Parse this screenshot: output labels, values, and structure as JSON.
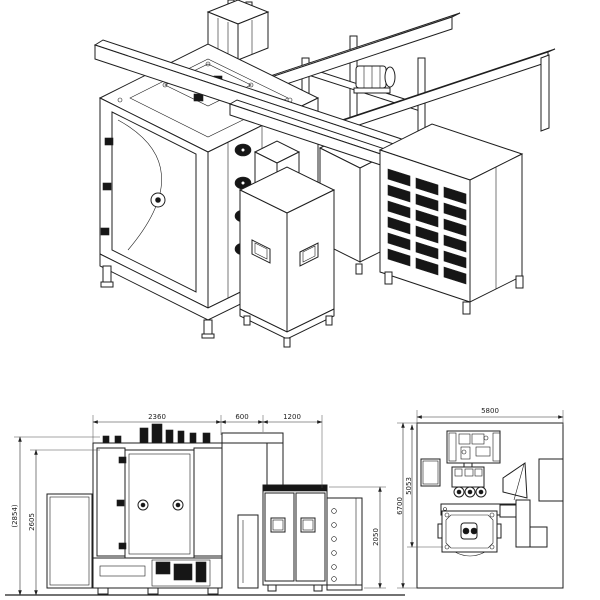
{
  "drawing": {
    "type": "machine-general-arrangement",
    "colors": {
      "line": "#1f1f1f",
      "dark_fill": "#161616",
      "dim_text": "#222222",
      "background": "#ffffff"
    }
  },
  "views": {
    "isometric": {
      "name": "isometric-view"
    },
    "front": {
      "dims": {
        "chamber_width": "2360",
        "gap_width": "600",
        "cabinet_width": "1200",
        "overall_height": "(2854)",
        "body_height": "2605",
        "cabinet_height": "2050"
      }
    },
    "plan": {
      "dims": {
        "overall_width": "5800",
        "overall_depth": "6700",
        "machine_depth": "5053"
      }
    }
  }
}
